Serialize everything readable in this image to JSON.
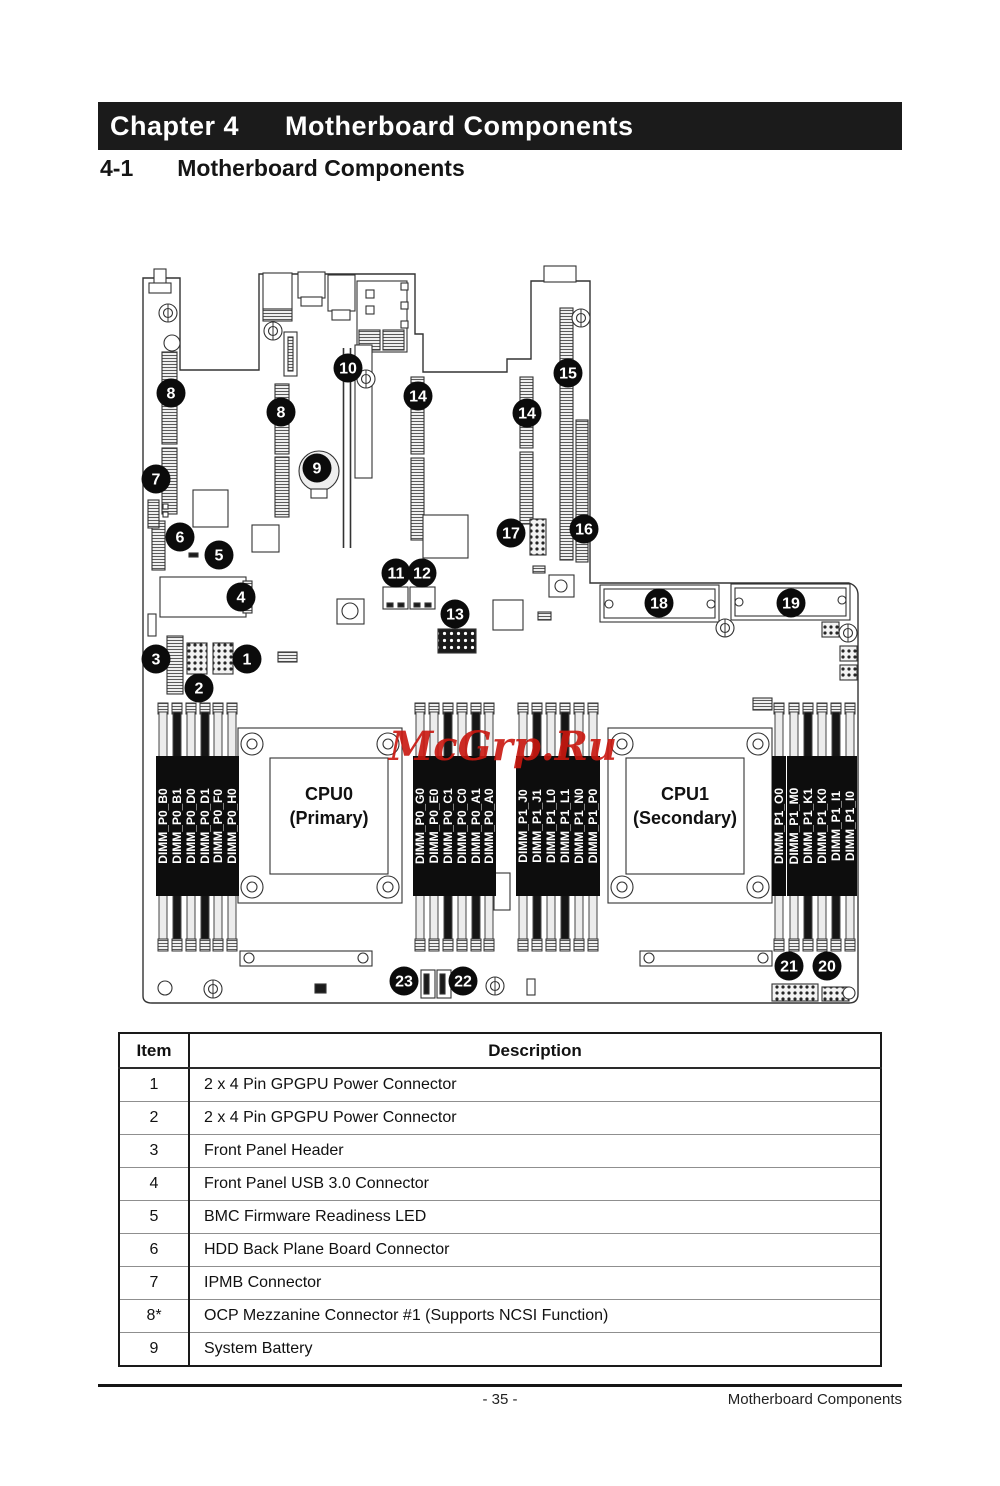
{
  "page": {
    "chapter_label": "Chapter 4",
    "chapter_title": "Motherboard Components",
    "section_number": "4-1",
    "section_title": "Motherboard Components",
    "footer_page": "- 35 -",
    "footer_right": "Motherboard Components"
  },
  "table": {
    "headers": [
      "Item",
      "Description"
    ],
    "rows": [
      [
        "1",
        "2 x 4 Pin GPGPU Power Connector"
      ],
      [
        "2",
        "2 x 4 Pin GPGPU Power Connector"
      ],
      [
        "3",
        "Front Panel Header"
      ],
      [
        "4",
        "Front Panel USB 3.0 Connector"
      ],
      [
        "5",
        "BMC Firmware Readiness LED"
      ],
      [
        "6",
        "HDD Back Plane Board Connector"
      ],
      [
        "7",
        "IPMB Connector"
      ],
      [
        "8*",
        "OCP Mezzanine Connector #1 (Supports NCSI Function)"
      ],
      [
        "9",
        "System Battery"
      ]
    ]
  },
  "diagram": {
    "watermark": {
      "text": "McGrp.Ru",
      "x": 503,
      "y": 760,
      "color": "#c9170f",
      "font_size": 40
    },
    "cpus": [
      {
        "name": "CPU0",
        "subtitle": "(Primary)",
        "cx": 329,
        "cy": 806
      },
      {
        "name": "CPU1",
        "subtitle": "(Secondary)",
        "cx": 685,
        "cy": 806
      }
    ],
    "dimm_groups": [
      {
        "centers": [
          163,
          177,
          191,
          205,
          218,
          232
        ],
        "slots": [
          {
            "label": "DIMM_P0_B0",
            "dark": false
          },
          {
            "label": "DIMM_P0_B1",
            "dark": true
          },
          {
            "label": "DIMM_P0_D0",
            "dark": false
          },
          {
            "label": "DIMM_P0_D1",
            "dark": true
          },
          {
            "label": "DIMM_P0_F0",
            "dark": false
          },
          {
            "label": "DIMM_P0_H0",
            "dark": false
          }
        ]
      },
      {
        "centers": [
          420,
          434,
          448,
          462,
          476,
          489
        ],
        "slots": [
          {
            "label": "DIMM_P0_G0",
            "dark": false
          },
          {
            "label": "DIMM_P0_E0",
            "dark": false
          },
          {
            "label": "DIMM_P0_C1",
            "dark": true
          },
          {
            "label": "DIMM_P0_C0",
            "dark": false
          },
          {
            "label": "DIMM_P0_A1",
            "dark": true
          },
          {
            "label": "DIMM_P0_A0",
            "dark": false
          }
        ]
      },
      {
        "centers": [
          523,
          537,
          551,
          565,
          579,
          593
        ],
        "slots": [
          {
            "label": "DIMM_P1_J0",
            "dark": false
          },
          {
            "label": "DIMM_P1_J1",
            "dark": true
          },
          {
            "label": "DIMM_P1_L0",
            "dark": false
          },
          {
            "label": "DIMM_P1_L1",
            "dark": true
          },
          {
            "label": "DIMM_P1_N0",
            "dark": false
          },
          {
            "label": "DIMM_P1_P0",
            "dark": false
          }
        ]
      },
      {
        "centers": [
          779,
          794,
          808,
          822,
          836,
          850
        ],
        "slots": [
          {
            "label": "DIMM_P1_O0",
            "dark": false
          },
          {
            "label": "DIMM_P1_M0",
            "dark": false
          },
          {
            "label": "DIMM_P1_K1",
            "dark": true
          },
          {
            "label": "DIMM_P1_K0",
            "dark": false
          },
          {
            "label": "DIMM_P1_I1",
            "dark": true
          },
          {
            "label": "DIMM_P1_I0",
            "dark": false
          }
        ]
      }
    ],
    "callouts": [
      {
        "n": "8",
        "x": 171,
        "y": 393
      },
      {
        "n": "8",
        "x": 281,
        "y": 412
      },
      {
        "n": "10",
        "x": 348,
        "y": 368
      },
      {
        "n": "14",
        "x": 418,
        "y": 396
      },
      {
        "n": "15",
        "x": 568,
        "y": 373
      },
      {
        "n": "14",
        "x": 527,
        "y": 413
      },
      {
        "n": "9",
        "x": 317,
        "y": 468
      },
      {
        "n": "7",
        "x": 156,
        "y": 479
      },
      {
        "n": "6",
        "x": 180,
        "y": 537
      },
      {
        "n": "5",
        "x": 219,
        "y": 555
      },
      {
        "n": "4",
        "x": 241,
        "y": 597
      },
      {
        "n": "3",
        "x": 156,
        "y": 659
      },
      {
        "n": "1",
        "x": 247,
        "y": 659
      },
      {
        "n": "2",
        "x": 199,
        "y": 688
      },
      {
        "n": "11",
        "x": 396,
        "y": 573
      },
      {
        "n": "12",
        "x": 422,
        "y": 573
      },
      {
        "n": "13",
        "x": 455,
        "y": 614
      },
      {
        "n": "17",
        "x": 511,
        "y": 533
      },
      {
        "n": "16",
        "x": 584,
        "y": 529
      },
      {
        "n": "18",
        "x": 659,
        "y": 603
      },
      {
        "n": "19",
        "x": 791,
        "y": 603
      },
      {
        "n": "21",
        "x": 789,
        "y": 966
      },
      {
        "n": "20",
        "x": 827,
        "y": 966
      },
      {
        "n": "23",
        "x": 404,
        "y": 981
      },
      {
        "n": "22",
        "x": 463,
        "y": 981
      }
    ]
  }
}
